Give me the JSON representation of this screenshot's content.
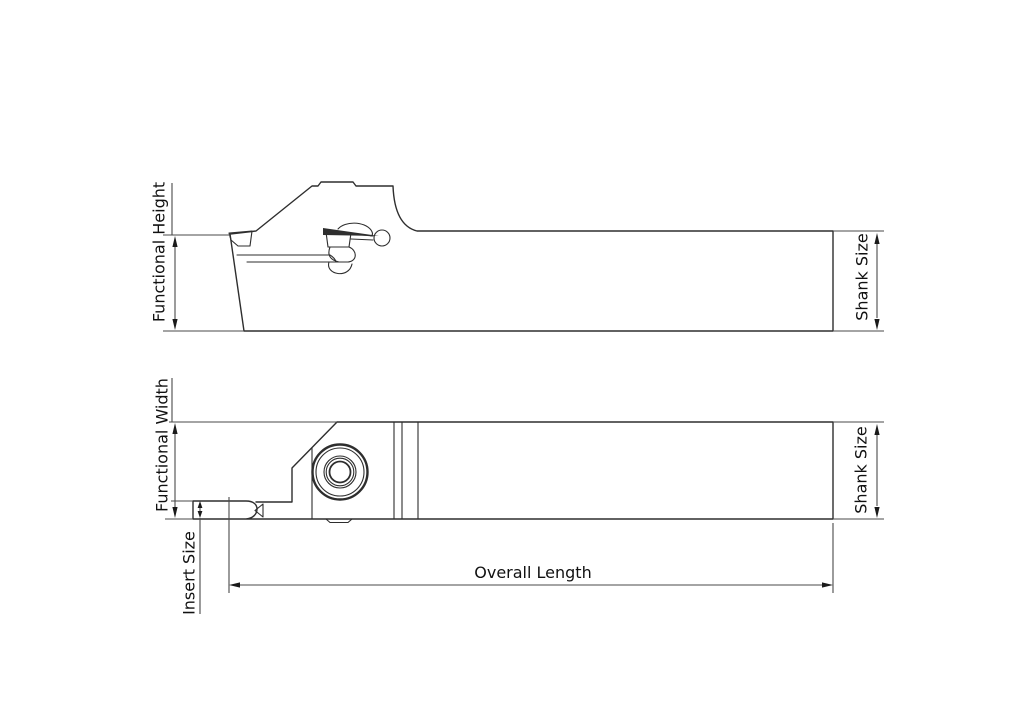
{
  "labels": {
    "side_view": {
      "functional_height": "Functional Height",
      "shank_size": "Shank Size"
    },
    "plan_view": {
      "functional_width": "Functional Width",
      "insert_size": "Insert Size",
      "shank_size": "Shank Size",
      "overall_length": "Overall Length"
    }
  },
  "colors": {
    "background": "#ffffff",
    "part_line": "#2e2e2e",
    "dimension_line": "#4a4a4a",
    "label_text": "#111111"
  }
}
